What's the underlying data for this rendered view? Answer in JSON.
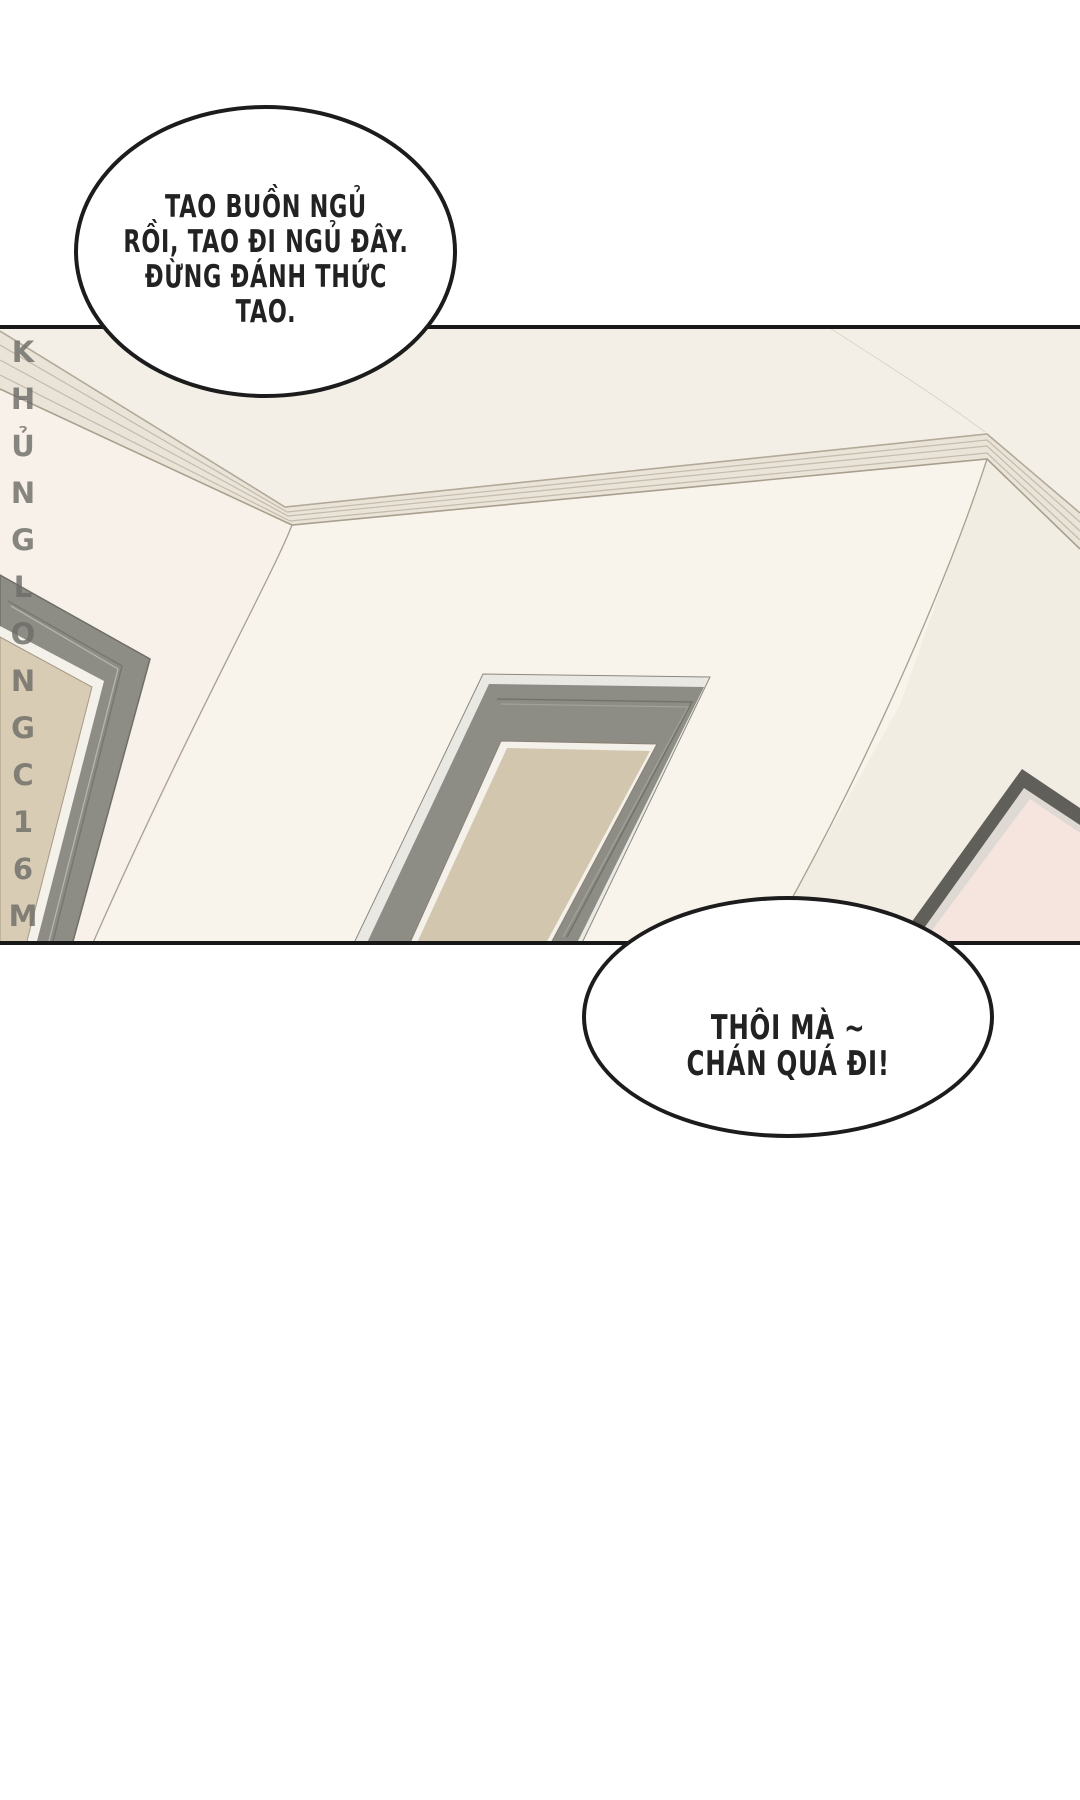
{
  "page": {
    "background": "#ffffff"
  },
  "panel": {
    "border_color": "#181818"
  },
  "speech_bubbles": {
    "top": {
      "lines": [
        "TAO BUỒN NGỦ",
        "RỒI, TAO ĐI NGỦ ĐÂY.",
        "ĐỪNG ĐÁNH THỨC",
        "TAO."
      ]
    },
    "bottom": {
      "lines": [
        "THÔI MÀ ~",
        "CHÁN QUÁ ĐI!"
      ]
    }
  },
  "watermark": {
    "text": "KHỦNGLONGC16M",
    "color": "#6e6c68"
  },
  "palette": {
    "wall_main": "#f8f3eb",
    "wall_left": "#f7f1ea",
    "wall_right": "#f2ede3",
    "ceiling": "#f4efe6",
    "molding_fill": "#eae3d7",
    "molding_line": "#c3bbac",
    "seam_line": "#a89f90",
    "door_frame_gray": "#8d8c85",
    "door_bevel_light": "#e9e8e3",
    "door_trim_white": "#f4f1ea",
    "door_slab_beige": "#d3c6ae",
    "door_slab_beige_left": "#d8ccb5",
    "right_door_frame": "#605f59",
    "right_door_trim": "#dedad3",
    "right_door_slab_pink": "#f6e4df",
    "border_black": "#181818"
  }
}
